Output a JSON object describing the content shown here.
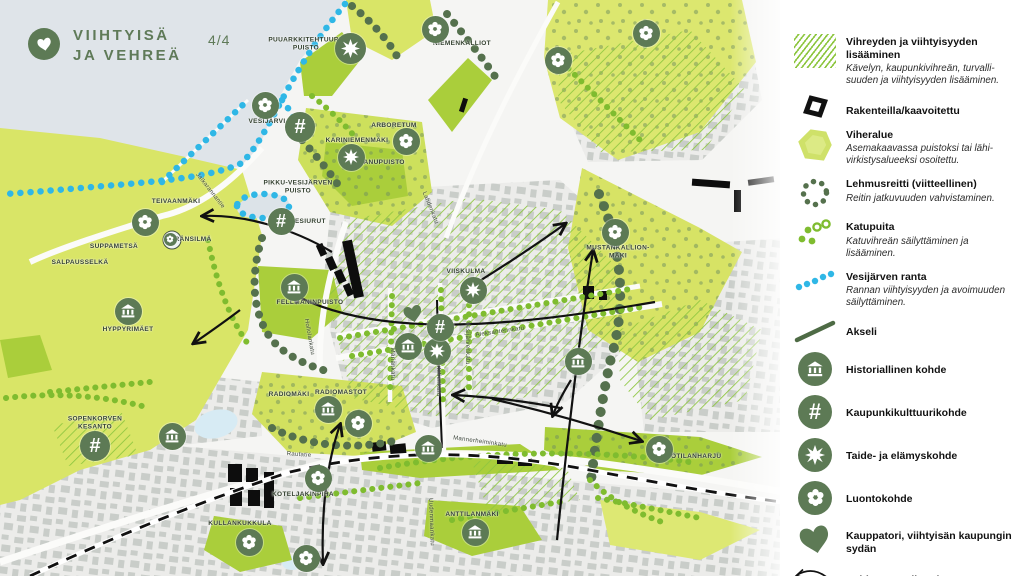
{
  "header": {
    "icon": "heart-icon",
    "title_line1": "VIIHTYISÄ",
    "title_line2": "JA VEHREÄ",
    "page_indicator": "4/4"
  },
  "colors": {
    "accent_green": "#5d7a55",
    "bright_green": "#8dc63f",
    "pale_area_green": "#d9e567",
    "shore_blue": "#2fb7e6",
    "water": "#dfe4e9",
    "ink": "#111111"
  },
  "legend": {
    "items": [
      {
        "icon": "green-hatch-swatch",
        "title": "Vihreyden ja viihtyisyyden lisääminen",
        "desc": "Kävelyn, kaupunkivihreän, turvalli­suuden ja viihtyisyyden lisääminen."
      },
      {
        "icon": "under-construction-swatch",
        "title": "Rakenteilla/kaavoitettu",
        "desc": ""
      },
      {
        "icon": "green-area-swatch",
        "title": "Viheralue",
        "desc": "Asemakaavassa puistoksi tai lähi­virkistysalueeksi osoitettu."
      },
      {
        "icon": "dotted-loop-swatch",
        "title": "Lehmusreitti (viitteellinen)",
        "desc": "Reitin jatkuvuuden vahvistaminen."
      },
      {
        "icon": "street-trees-swatch",
        "title": "Katupuita",
        "desc": "Katuvihreän säilyttäminen ja lisääminen."
      },
      {
        "icon": "blue-dots-swatch",
        "title": "Vesijärven ranta",
        "desc": "Rannan viihtyisyyden ja avoimuuden säilyttäminen."
      },
      {
        "icon": "axis-line-swatch",
        "title": "Akseli",
        "desc": ""
      },
      {
        "icon": "historic-site-icon",
        "title": "Historiallinen kohde",
        "desc": ""
      },
      {
        "icon": "urban-culture-icon",
        "title": "Kaupunkikulttuurikohde",
        "desc": ""
      },
      {
        "icon": "art-experience-icon",
        "title": "Taide- ja elämyskohde",
        "desc": ""
      },
      {
        "icon": "nature-site-icon",
        "title": "Luontokohde",
        "desc": ""
      },
      {
        "icon": "market-heart-icon",
        "title": "Kauppatori, viihtyisän kaupungin sydän",
        "desc": ""
      },
      {
        "icon": "green-connection-arrow-icon",
        "title": "Kehitettävä viheryhteys",
        "desc": ""
      }
    ]
  },
  "map": {
    "area_labels": [
      {
        "text": "PUUARKKITEHTUURI-\nPUISTO",
        "x": 306,
        "y": 45
      },
      {
        "text": "NIEMENKALLIOT",
        "x": 462,
        "y": 44
      },
      {
        "text": "VESIJÄRVI",
        "x": 267,
        "y": 122
      },
      {
        "text": "ARBORETUM",
        "x": 394,
        "y": 126
      },
      {
        "text": "KARINIEMENMÄKI",
        "x": 357,
        "y": 141
      },
      {
        "text": "LANUPUISTO",
        "x": 382,
        "y": 163
      },
      {
        "text": "PIKKU-VESIJÄRVEN\nPUISTO",
        "x": 298,
        "y": 188
      },
      {
        "text": "TEIVAANMÄKI",
        "x": 176,
        "y": 202
      },
      {
        "text": "HÄRÄNSILMÄ",
        "x": 188,
        "y": 240
      },
      {
        "text": "SUPPAMETSÄ",
        "x": 114,
        "y": 247
      },
      {
        "text": "SALPAUSSELKÄ",
        "x": 80,
        "y": 263
      },
      {
        "text": "HYPPYRIMÄET",
        "x": 128,
        "y": 330
      },
      {
        "text": "VESIURUT",
        "x": 308,
        "y": 222
      },
      {
        "text": "FELLMANINPUISTO",
        "x": 310,
        "y": 303
      },
      {
        "text": "VIISKULMA",
        "x": 466,
        "y": 272
      },
      {
        "text": "MUSTANKALLION-\nMÄKI",
        "x": 618,
        "y": 253
      },
      {
        "text": "SOPENKORVEN\nKESANTO",
        "x": 95,
        "y": 424
      },
      {
        "text": "RADIOMÄKI",
        "x": 289,
        "y": 395
      },
      {
        "text": "RADIOMASTOT",
        "x": 341,
        "y": 393
      },
      {
        "text": "KULLANKUKKULA",
        "x": 240,
        "y": 524
      },
      {
        "text": "KOTELJAKINPIHA",
        "x": 303,
        "y": 495
      },
      {
        "text": "ANTTILANMÄKI",
        "x": 472,
        "y": 515
      },
      {
        "text": "LOTILANHARJU",
        "x": 694,
        "y": 457
      }
    ],
    "street_labels": [
      {
        "text": "Jalkarannantie",
        "x": 210,
        "y": 191,
        "angle": 52
      },
      {
        "text": "Lahdenkatu",
        "x": 430,
        "y": 208,
        "angle": 68
      },
      {
        "text": "Hollolankatu",
        "x": 309,
        "y": 337,
        "angle": 80
      },
      {
        "text": "Aleksanterinkatu",
        "x": 500,
        "y": 332,
        "angle": -8
      },
      {
        "text": "Mariankatu",
        "x": 392,
        "y": 364,
        "angle": 90
      },
      {
        "text": "Rautatienkatu",
        "x": 438,
        "y": 376,
        "angle": 90
      },
      {
        "text": "Vesijärvenkatu",
        "x": 467,
        "y": 343,
        "angle": 90
      },
      {
        "text": "Mannerheiminkatu",
        "x": 480,
        "y": 442,
        "angle": 8
      },
      {
        "text": "Rautatie",
        "x": 299,
        "y": 455,
        "angle": 4
      },
      {
        "text": "Uudenmaankatu",
        "x": 431,
        "y": 522,
        "angle": 88
      }
    ],
    "pois": [
      {
        "type": "nature",
        "x": 435,
        "y": 29
      },
      {
        "type": "nature",
        "x": 558,
        "y": 60
      },
      {
        "type": "nature",
        "x": 646,
        "y": 33
      },
      {
        "type": "nature",
        "x": 265,
        "y": 105
      },
      {
        "type": "nature",
        "x": 406,
        "y": 141
      },
      {
        "type": "nature",
        "x": 145,
        "y": 222
      },
      {
        "type": "nature",
        "x": 170,
        "y": 239,
        "size": 13
      },
      {
        "type": "nature",
        "x": 615,
        "y": 232
      },
      {
        "type": "nature",
        "x": 358,
        "y": 423
      },
      {
        "type": "nature",
        "x": 318,
        "y": 478
      },
      {
        "type": "nature",
        "x": 249,
        "y": 542
      },
      {
        "type": "nature",
        "x": 306,
        "y": 558
      },
      {
        "type": "nature",
        "x": 659,
        "y": 449
      },
      {
        "type": "art",
        "x": 350,
        "y": 48,
        "size": 31
      },
      {
        "type": "art",
        "x": 351,
        "y": 157
      },
      {
        "type": "art",
        "x": 473,
        "y": 290
      },
      {
        "type": "art",
        "x": 437,
        "y": 351
      },
      {
        "type": "culture",
        "x": 300,
        "y": 127,
        "size": 30
      },
      {
        "type": "culture",
        "x": 281,
        "y": 221
      },
      {
        "type": "culture",
        "x": 95,
        "y": 446,
        "size": 30
      },
      {
        "type": "culture",
        "x": 440,
        "y": 327
      },
      {
        "type": "historic",
        "x": 128,
        "y": 311
      },
      {
        "type": "historic",
        "x": 294,
        "y": 287
      },
      {
        "type": "historic",
        "x": 408,
        "y": 346
      },
      {
        "type": "historic",
        "x": 578,
        "y": 361
      },
      {
        "type": "historic",
        "x": 172,
        "y": 436
      },
      {
        "type": "historic",
        "x": 328,
        "y": 409
      },
      {
        "type": "historic",
        "x": 428,
        "y": 448
      },
      {
        "type": "historic",
        "x": 475,
        "y": 532
      },
      {
        "type": "heart",
        "x": 413,
        "y": 314
      }
    ]
  }
}
